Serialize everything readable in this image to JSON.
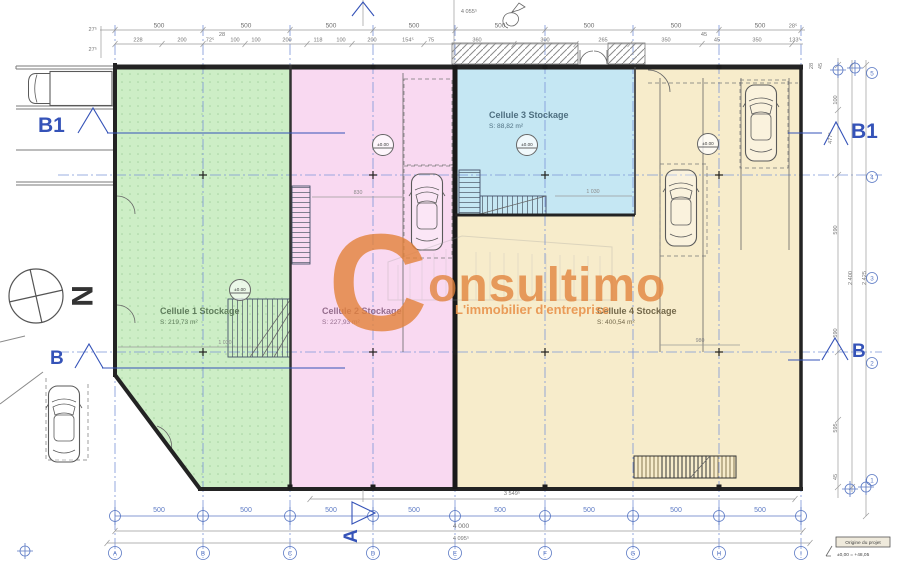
{
  "plan": {
    "cells": [
      {
        "name": "Cellule 1 Stockage",
        "area": "S: 219,73 m²",
        "fill": "#cdeec6"
      },
      {
        "name": "Cellule 2 Stockage",
        "area": "S: 227,93 m²",
        "fill": "#f9d9f1"
      },
      {
        "name": "Cellule 3 Stockage",
        "area": "S: 88,82 m²",
        "fill": "#c5e7f3"
      },
      {
        "name": "Cellule 4 Stockage",
        "area": "S: 400,54 m²",
        "fill": "#f7eccb"
      }
    ],
    "level_marker": "±0.00",
    "north": "N"
  },
  "watermark": {
    "logo_letter": "C",
    "brand_suffix": "onsultimo",
    "tagline": "L'immobilier d'entreprise",
    "color": "#e2813a"
  },
  "sections": {
    "b1_left": "B1",
    "b_left": "B",
    "b1_right": "B1",
    "b_right": "B",
    "a_bottom": "A"
  },
  "dims": {
    "top_major": [
      "500",
      "500",
      "500",
      "500",
      "500",
      "500",
      "500",
      "500"
    ],
    "top_end": "28⁵",
    "top_total": "4 055⁵",
    "top_minor": [
      "228",
      "200",
      "72⁵",
      "28",
      "100",
      "100",
      "200",
      "118",
      "100",
      "200",
      "154⁵",
      "75",
      "360",
      "300",
      "265",
      "350",
      "45",
      "45",
      "350",
      "133⁵"
    ],
    "left_upper": [
      "27⁵",
      "27⁵"
    ],
    "bottom_major": [
      "500",
      "500",
      "500",
      "500",
      "500",
      "500",
      "500",
      "500"
    ],
    "bottom_span": "3 549⁵",
    "bottom_total_a": "4 000",
    "bottom_total_b": "4 095⁵",
    "right_minor_top": [
      "28",
      "45",
      "100"
    ],
    "right_477": "477⁵",
    "right_590_a": "590",
    "right_590_b": "590",
    "right_595": "595",
    "right_45": "45",
    "right_total_a": "2 400",
    "right_total_b": "2 425",
    "inner": {
      "green": "1 030",
      "pink": "830",
      "blue": "1 030",
      "beige": "980"
    }
  },
  "axes": {
    "bottom": [
      "A",
      "B",
      "C",
      "D",
      "E",
      "F",
      "G",
      "H",
      "I"
    ],
    "right": [
      "5",
      "4",
      "3",
      "2",
      "1"
    ]
  },
  "origin": {
    "label": "Origine du projet",
    "value": "±0,00 = +48,05"
  }
}
